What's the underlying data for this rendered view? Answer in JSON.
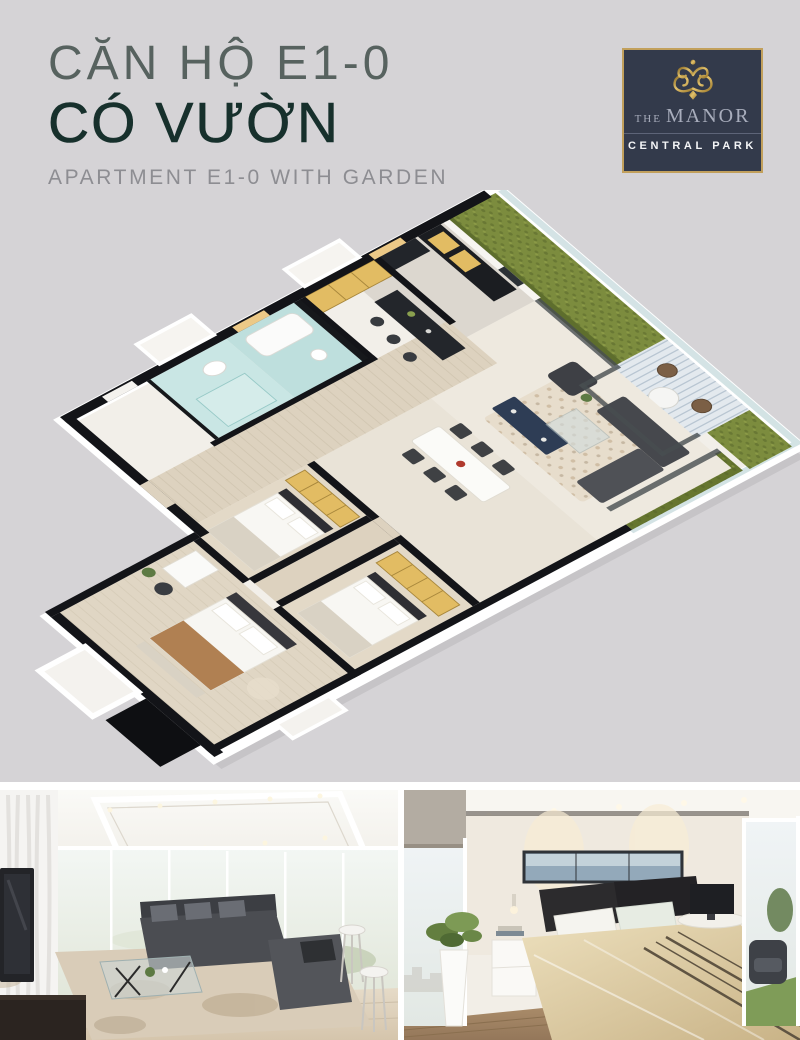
{
  "page": {
    "background": "#d5d3d6",
    "divider_band": "#ffffff"
  },
  "header": {
    "title_line1": "CĂN HỘ E1-0",
    "title_line2": "CÓ VƯỜN",
    "subtitle": "APARTMENT E1-0 WITH GARDEN",
    "title_color": "#57625f",
    "title_strong_color": "#17302c",
    "subtitle_color": "#8d8d92"
  },
  "logo": {
    "prefix": "THE",
    "name": "MANOR",
    "tagline": "CENTRAL PARK",
    "background": "#333a4b",
    "gold": "#c2a05c",
    "silver": "#a8adbc"
  },
  "floor_plan": {
    "kind": "isometric-3d-apartment-floor-plan",
    "garden_green": "#7c8c3e",
    "hedge_green": "#5e6e2d",
    "wall_black": "#131418",
    "slab_white": "#f2efe9",
    "wood_floor": "#ddd2bf",
    "cabinet_gold": "#e2bc63",
    "bath_glass_teal": "#bedfdd",
    "media_console_navy": "#2e3d55",
    "deck_plank": "#e3e9ee"
  },
  "photos": {
    "left_photo_subject": "living-room-interior-render",
    "right_photo_subject": "bedroom-interior-render"
  }
}
